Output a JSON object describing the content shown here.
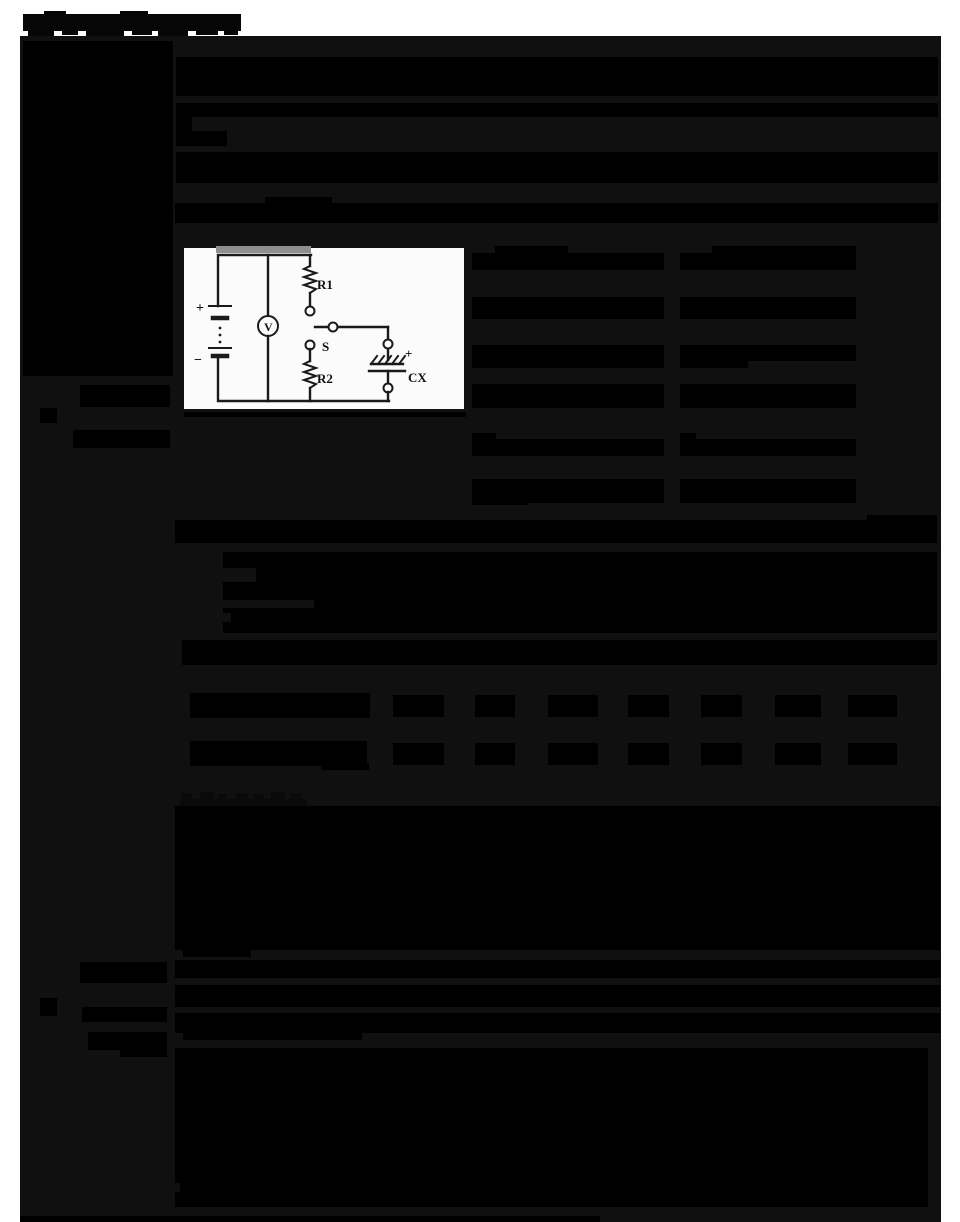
{
  "page": {
    "width": 960,
    "height": 1222,
    "background": "#ffffff",
    "content_background": "#101010",
    "redaction_color": "#000000",
    "notch_color": "#101010",
    "smudge_color": "#8f8f8f"
  },
  "circuit": {
    "figure": "electric-circuit-with-capacitor",
    "labels": {
      "battery_plus": "+",
      "battery_minus": "−",
      "voltmeter": "V",
      "resistor1": "R1",
      "resistor2": "R2",
      "switch": "S",
      "capacitor_plus": "+",
      "capacitor": "CX"
    }
  },
  "title": {
    "bits": [
      {
        "x": 23,
        "y": 14,
        "w": 218,
        "h": 17,
        "c": "#060606",
        "n": "page-title-blob"
      },
      {
        "x": 28,
        "y": 31,
        "w": 26,
        "h": 5,
        "c": "#060606"
      },
      {
        "x": 62,
        "y": 31,
        "w": 16,
        "h": 4,
        "c": "#060606"
      },
      {
        "x": 86,
        "y": 29,
        "w": 38,
        "h": 7,
        "c": "#060606"
      },
      {
        "x": 132,
        "y": 31,
        "w": 20,
        "h": 4,
        "c": "#060606"
      },
      {
        "x": 158,
        "y": 30,
        "w": 30,
        "h": 6,
        "c": "#060606"
      },
      {
        "x": 196,
        "y": 31,
        "w": 22,
        "h": 4,
        "c": "#060606"
      },
      {
        "x": 224,
        "y": 31,
        "w": 14,
        "h": 4,
        "c": "#060606"
      },
      {
        "x": 44,
        "y": 11,
        "w": 22,
        "h": 3,
        "c": "#060606"
      },
      {
        "x": 120,
        "y": 11,
        "w": 28,
        "h": 3,
        "c": "#060606"
      }
    ]
  },
  "redactions": {
    "rects": [
      {
        "x": 23,
        "y": 41,
        "w": 150,
        "h": 335,
        "n": "left-margin-block"
      },
      {
        "x": 80,
        "y": 385,
        "w": 90,
        "h": 22,
        "n": "left-margin-line"
      },
      {
        "x": 40,
        "y": 408,
        "w": 17,
        "h": 15,
        "n": "section-bullet-square"
      },
      {
        "x": 73,
        "y": 430,
        "w": 97,
        "h": 18,
        "n": "left-margin-line"
      },
      {
        "x": 80,
        "y": 962,
        "w": 87,
        "h": 21,
        "n": "left-margin-line"
      },
      {
        "x": 40,
        "y": 998,
        "w": 17,
        "h": 18,
        "n": "section-bullet-square"
      },
      {
        "x": 82,
        "y": 1007,
        "w": 85,
        "h": 15,
        "n": "left-margin-line"
      },
      {
        "x": 88,
        "y": 1032,
        "w": 79,
        "h": 18,
        "n": "left-margin-line"
      },
      {
        "x": 120,
        "y": 1048,
        "w": 47,
        "h": 9,
        "n": "left-margin-line"
      },
      {
        "x": 176,
        "y": 57,
        "w": 762,
        "h": 39,
        "n": "paragraph-block"
      },
      {
        "x": 176,
        "y": 103,
        "w": 762,
        "h": 14,
        "n": "paragraph-block"
      },
      {
        "x": 176,
        "y": 117,
        "w": 16,
        "h": 14,
        "n": "paragraph-stub"
      },
      {
        "x": 176,
        "y": 131,
        "w": 51,
        "h": 15,
        "n": "paragraph-stub"
      },
      {
        "x": 176,
        "y": 152,
        "w": 762,
        "h": 31,
        "n": "paragraph-block"
      },
      {
        "x": 265,
        "y": 197,
        "w": 67,
        "h": 7,
        "n": "line-fragment"
      },
      {
        "x": 175,
        "y": 203,
        "w": 763,
        "h": 20,
        "n": "paragraph-block"
      },
      {
        "x": 495,
        "y": 246,
        "w": 73,
        "h": 8,
        "n": "table-cell-fragment"
      },
      {
        "x": 472,
        "y": 253,
        "w": 192,
        "h": 17,
        "n": "right-table-cell"
      },
      {
        "x": 712,
        "y": 246,
        "w": 144,
        "h": 8,
        "n": "table-cell-fragment"
      },
      {
        "x": 680,
        "y": 253,
        "w": 176,
        "h": 17,
        "n": "right-table-cell"
      },
      {
        "x": 472,
        "y": 297,
        "w": 192,
        "h": 22,
        "n": "right-table-cell"
      },
      {
        "x": 680,
        "y": 297,
        "w": 176,
        "h": 22,
        "n": "right-table-cell"
      },
      {
        "x": 472,
        "y": 345,
        "w": 192,
        "h": 23,
        "n": "right-table-cell"
      },
      {
        "x": 680,
        "y": 345,
        "w": 176,
        "h": 16,
        "n": "right-table-cell"
      },
      {
        "x": 680,
        "y": 361,
        "w": 68,
        "h": 7,
        "n": "table-cell-fragment"
      },
      {
        "x": 472,
        "y": 384,
        "w": 192,
        "h": 24,
        "n": "right-table-cell"
      },
      {
        "x": 680,
        "y": 384,
        "w": 176,
        "h": 24,
        "n": "right-table-cell"
      },
      {
        "x": 472,
        "y": 433,
        "w": 24,
        "h": 7,
        "n": "table-cell-fragment"
      },
      {
        "x": 472,
        "y": 439,
        "w": 192,
        "h": 17,
        "n": "right-table-cell"
      },
      {
        "x": 680,
        "y": 433,
        "w": 16,
        "h": 7,
        "n": "table-cell-fragment"
      },
      {
        "x": 680,
        "y": 439,
        "w": 176,
        "h": 17,
        "n": "right-table-cell"
      },
      {
        "x": 472,
        "y": 479,
        "w": 192,
        "h": 24,
        "n": "right-table-cell"
      },
      {
        "x": 472,
        "y": 498,
        "w": 56,
        "h": 7,
        "n": "table-cell-fragment"
      },
      {
        "x": 680,
        "y": 479,
        "w": 176,
        "h": 24,
        "n": "right-table-cell"
      },
      {
        "x": 184,
        "y": 412,
        "w": 282,
        "h": 5,
        "n": "rule-under-figure"
      },
      {
        "x": 867,
        "y": 515,
        "w": 70,
        "h": 6,
        "n": "line-fragment"
      },
      {
        "x": 175,
        "y": 520,
        "w": 762,
        "h": 23,
        "n": "paragraph-block"
      },
      {
        "x": 223,
        "y": 552,
        "w": 714,
        "h": 81,
        "n": "paragraph-block"
      },
      {
        "x": 223,
        "y": 568,
        "w": 33,
        "h": 14,
        "c": "#101010",
        "n": "list-marker-gap"
      },
      {
        "x": 223,
        "y": 600,
        "w": 91,
        "h": 8,
        "c": "#101010",
        "n": "list-marker-gap"
      },
      {
        "x": 223,
        "y": 613,
        "w": 8,
        "h": 9,
        "c": "#101010",
        "n": "list-marker-gap"
      },
      {
        "x": 182,
        "y": 640,
        "w": 755,
        "h": 25,
        "n": "paragraph-block"
      },
      {
        "x": 190,
        "y": 693,
        "w": 180,
        "h": 25,
        "n": "data-table-row-header"
      },
      {
        "x": 190,
        "y": 741,
        "w": 177,
        "h": 25,
        "n": "data-table-row-header"
      },
      {
        "x": 321,
        "y": 763,
        "w": 48,
        "h": 7,
        "n": "table-cell-fragment"
      },
      {
        "x": 393,
        "y": 695,
        "w": 51,
        "h": 22,
        "n": "data-table-cell"
      },
      {
        "x": 475,
        "y": 695,
        "w": 40,
        "h": 22,
        "n": "data-table-cell"
      },
      {
        "x": 548,
        "y": 695,
        "w": 50,
        "h": 22,
        "n": "data-table-cell"
      },
      {
        "x": 628,
        "y": 695,
        "w": 41,
        "h": 22,
        "n": "data-table-cell"
      },
      {
        "x": 701,
        "y": 695,
        "w": 41,
        "h": 22,
        "n": "data-table-cell"
      },
      {
        "x": 775,
        "y": 695,
        "w": 46,
        "h": 22,
        "n": "data-table-cell"
      },
      {
        "x": 848,
        "y": 695,
        "w": 49,
        "h": 22,
        "n": "data-table-cell"
      },
      {
        "x": 393,
        "y": 743,
        "w": 51,
        "h": 22,
        "n": "data-table-cell"
      },
      {
        "x": 475,
        "y": 743,
        "w": 40,
        "h": 22,
        "n": "data-table-cell"
      },
      {
        "x": 548,
        "y": 743,
        "w": 50,
        "h": 22,
        "n": "data-table-cell"
      },
      {
        "x": 628,
        "y": 743,
        "w": 41,
        "h": 22,
        "n": "data-table-cell"
      },
      {
        "x": 701,
        "y": 743,
        "w": 41,
        "h": 22,
        "n": "data-table-cell"
      },
      {
        "x": 775,
        "y": 743,
        "w": 46,
        "h": 22,
        "n": "data-table-cell"
      },
      {
        "x": 848,
        "y": 743,
        "w": 49,
        "h": 22,
        "n": "data-table-cell"
      },
      {
        "x": 180,
        "y": 799,
        "w": 127,
        "h": 9,
        "c": "#0a0a0a",
        "n": "heading-blob"
      },
      {
        "x": 182,
        "y": 793,
        "w": 10,
        "h": 6,
        "c": "#0a0a0a"
      },
      {
        "x": 200,
        "y": 792,
        "w": 14,
        "h": 7,
        "c": "#0a0a0a"
      },
      {
        "x": 218,
        "y": 794,
        "w": 8,
        "h": 5,
        "c": "#0a0a0a"
      },
      {
        "x": 236,
        "y": 793,
        "w": 12,
        "h": 6,
        "c": "#0a0a0a"
      },
      {
        "x": 254,
        "y": 794,
        "w": 10,
        "h": 5,
        "c": "#0a0a0a"
      },
      {
        "x": 271,
        "y": 792,
        "w": 14,
        "h": 7,
        "c": "#0a0a0a"
      },
      {
        "x": 291,
        "y": 794,
        "w": 10,
        "h": 5,
        "c": "#0a0a0a"
      },
      {
        "x": 175,
        "y": 806,
        "w": 765,
        "h": 144,
        "n": "paragraph-block"
      },
      {
        "x": 183,
        "y": 948,
        "w": 68,
        "h": 9,
        "n": "paragraph-stub"
      },
      {
        "x": 175,
        "y": 960,
        "w": 765,
        "h": 18,
        "n": "paragraph-block"
      },
      {
        "x": 175,
        "y": 985,
        "w": 765,
        "h": 22,
        "n": "paragraph-block"
      },
      {
        "x": 175,
        "y": 1013,
        "w": 765,
        "h": 20,
        "n": "paragraph-block"
      },
      {
        "x": 183,
        "y": 1033,
        "w": 179,
        "h": 7,
        "n": "paragraph-stub"
      },
      {
        "x": 175,
        "y": 1048,
        "w": 753,
        "h": 159,
        "n": "paragraph-block"
      },
      {
        "x": 175,
        "y": 1183,
        "w": 5,
        "h": 9,
        "c": "#101010",
        "n": "list-marker-gap"
      },
      {
        "x": 20,
        "y": 1216,
        "w": 580,
        "h": 6,
        "n": "page-edge-shadow"
      }
    ]
  }
}
